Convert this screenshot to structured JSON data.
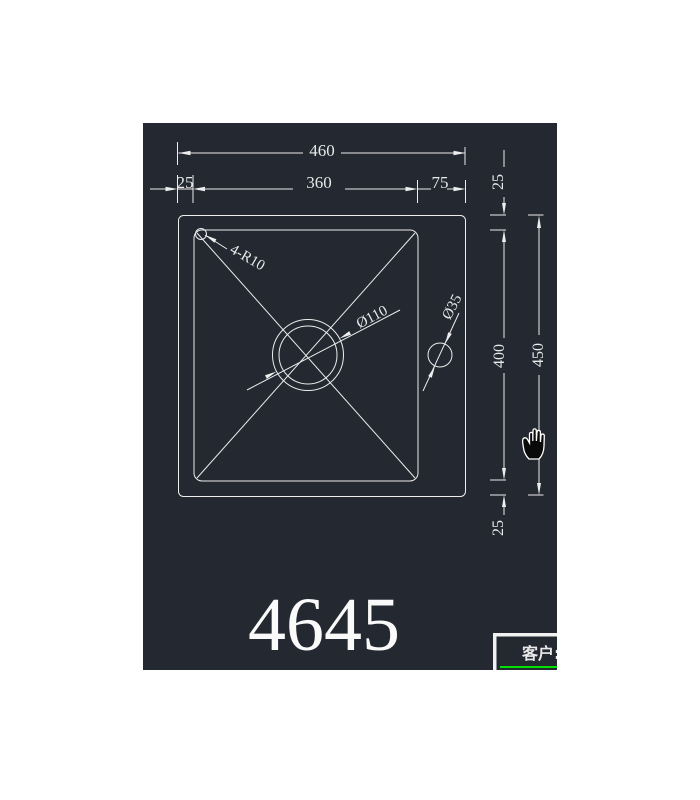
{
  "colors": {
    "page_bg": "#ffffff",
    "canvas_bg": "#232831",
    "line": "#ededed",
    "accent_green": "#00e000"
  },
  "drawing": {
    "model_number": "4645",
    "dims": {
      "total_width": "460",
      "left_margin": "25",
      "bowl_width": "360",
      "right_margin": "75",
      "top_margin": "25",
      "bowl_height": "400",
      "total_height": "450",
      "bottom_margin": "25"
    },
    "annotations": {
      "corner_radius": "4-R10",
      "drain_diameter": "Ø110",
      "hole_diameter": "Ø35"
    }
  },
  "title_block": {
    "customer_label": "客户:"
  },
  "cursor": {
    "name": "pan-hand"
  }
}
